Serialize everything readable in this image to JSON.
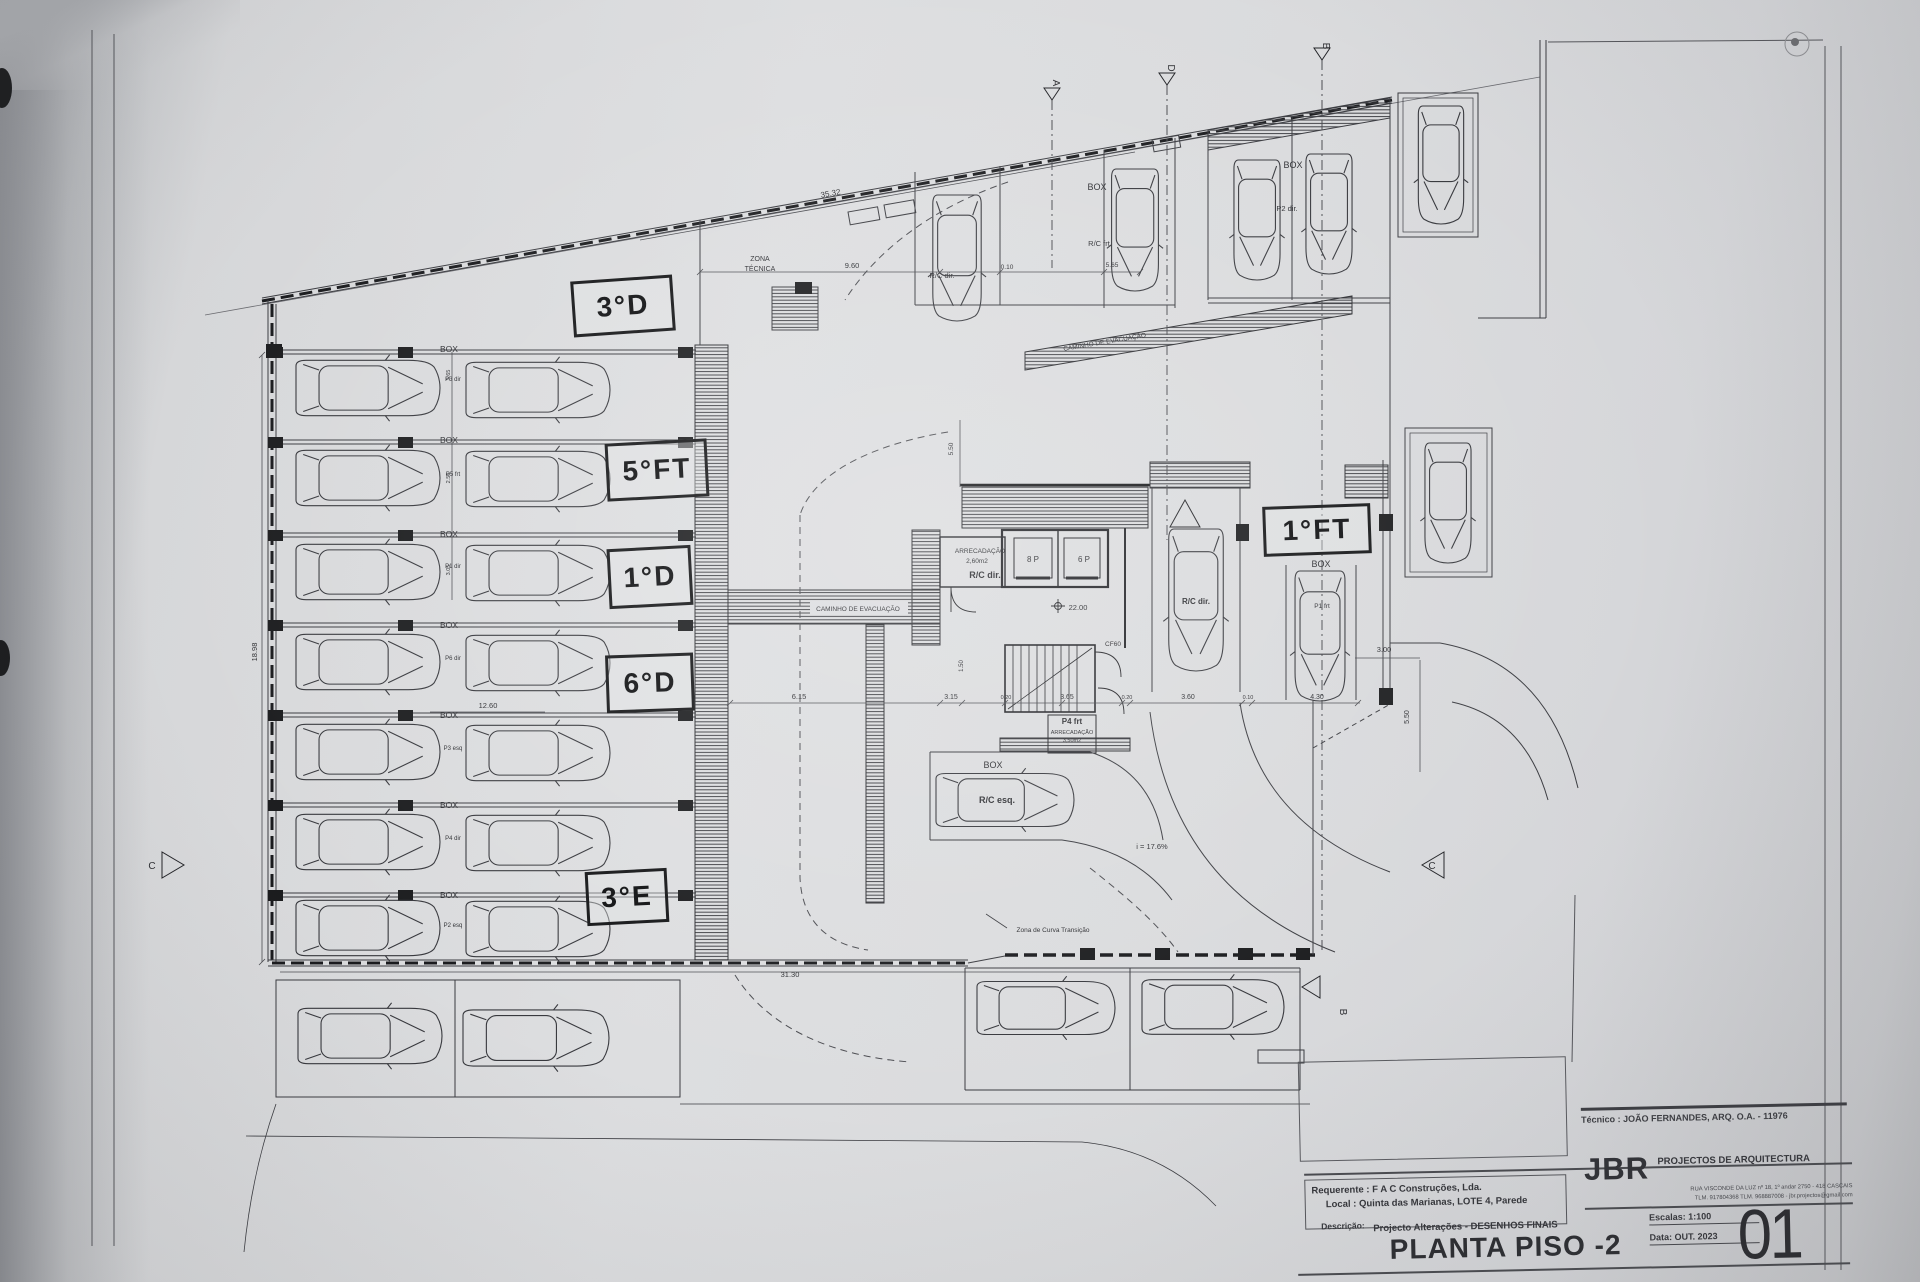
{
  "titleblock": {
    "tecnico": "Técnico : JOÃO FERNANDES, ARQ.   O.A. - 11976",
    "firm_name": "JBR",
    "firm_tagline": "PROJECTOS DE ARQUITECTURA",
    "firm_addr1": "RUA VISCONDE DA LUZ nº 18, 1º andar  2750 - 418  CASCAIS",
    "firm_addr2": "TLM. 917804368 TLM. 968887008 - jbr.projectos@gmail.com",
    "requerente": "Requerente : F A C  Construções, Lda.",
    "local": "Local : Quinta das Marianas, LOTE 4, Parede",
    "descricao_label": "Descrição:",
    "descricao_value": "Projecto Alterações - DESENHOS FINAIS",
    "drawing_title": "PLANTA PISO -2",
    "escala": "Escalas:  1:100",
    "data": "Data: OUT.  2023",
    "sheet_number": "01"
  },
  "handwritten": [
    {
      "text": "3°D",
      "x": 572,
      "y": 278,
      "w": 96,
      "h": 50,
      "rot": -4
    },
    {
      "text": "5°FT",
      "x": 606,
      "y": 441,
      "w": 96,
      "h": 52,
      "rot": -3
    },
    {
      "text": "1°D",
      "x": 608,
      "y": 547,
      "w": 78,
      "h": 54,
      "rot": -3
    },
    {
      "text": "6°D",
      "x": 606,
      "y": 654,
      "w": 82,
      "h": 52,
      "rot": -2
    },
    {
      "text": "3°E",
      "x": 586,
      "y": 870,
      "w": 76,
      "h": 48,
      "rot": -3
    },
    {
      "text": "1°FT",
      "x": 1263,
      "y": 505,
      "w": 102,
      "h": 44,
      "rot": -2
    }
  ],
  "plan": {
    "labels": [
      {
        "t": "ZONA",
        "x": 760,
        "y": 261,
        "s": 7
      },
      {
        "t": "TÉCNICA",
        "x": 760,
        "y": 271,
        "s": 7
      },
      {
        "t": "35.32",
        "x": 831,
        "y": 196,
        "s": 8,
        "r": -10
      },
      {
        "t": "9.60",
        "x": 852,
        "y": 268,
        "s": 7.5
      },
      {
        "t": "0.10",
        "x": 1007,
        "y": 269,
        "s": 6.5
      },
      {
        "t": "5.65",
        "x": 1112,
        "y": 267,
        "s": 6.5
      },
      {
        "t": "R/C dir.",
        "x": 942,
        "y": 278,
        "s": 7.5
      },
      {
        "t": "BOX",
        "x": 1097,
        "y": 190,
        "s": 9
      },
      {
        "t": "R/C frt",
        "x": 1099,
        "y": 246,
        "s": 7.5
      },
      {
        "t": "BOX",
        "x": 1293,
        "y": 168,
        "s": 9
      },
      {
        "t": "P2 dir.",
        "x": 1287,
        "y": 211,
        "s": 7.5
      },
      {
        "t": "CAMINHO DE EVACUAÇÃO",
        "x": 1105,
        "y": 344,
        "s": 6.5,
        "r": -9.5
      },
      {
        "t": "CAMINHO DE EVACUAÇÃO",
        "x": 858,
        "y": 611,
        "s": 6.5
      },
      {
        "t": "ARRECADAÇÃO",
        "x": 980,
        "y": 553,
        "s": 6.5
      },
      {
        "t": "2,60m2",
        "x": 977,
        "y": 563,
        "s": 6.5
      },
      {
        "t": "R/C dir.",
        "x": 985,
        "y": 578,
        "s": 9,
        "b": 1
      },
      {
        "t": "8 P",
        "x": 1033,
        "y": 562,
        "s": 8
      },
      {
        "t": "6 P",
        "x": 1084,
        "y": 562,
        "s": 8
      },
      {
        "t": "22.00",
        "x": 1078,
        "y": 610,
        "s": 7.5
      },
      {
        "t": "CF60",
        "x": 1113,
        "y": 646,
        "s": 6.5
      },
      {
        "t": "P4 frt",
        "x": 1072,
        "y": 724,
        "s": 8,
        "b": 1
      },
      {
        "t": "ARRECADAÇÃO",
        "x": 1072,
        "y": 734,
        "s": 5.5
      },
      {
        "t": "3,50m2",
        "x": 1072,
        "y": 742,
        "s": 5.5
      },
      {
        "t": "1.50",
        "x": 963,
        "y": 666,
        "s": 6,
        "r": -90
      },
      {
        "t": "5.50",
        "x": 953,
        "y": 449,
        "s": 6.5,
        "r": -90
      },
      {
        "t": "BOX",
        "x": 1321,
        "y": 567,
        "s": 9
      },
      {
        "t": "P1 frt",
        "x": 1322,
        "y": 608,
        "s": 6.5
      },
      {
        "t": "R/C dir.",
        "x": 1196,
        "y": 604,
        "s": 8,
        "b": 1
      },
      {
        "t": "3.00",
        "x": 1384,
        "y": 652,
        "s": 7.5
      },
      {
        "t": "5.50",
        "x": 1409,
        "y": 717,
        "s": 7,
        "r": -90
      },
      {
        "t": "BOX",
        "x": 993,
        "y": 768,
        "s": 9
      },
      {
        "t": "R/C esq.",
        "x": 997,
        "y": 803,
        "s": 9,
        "b": 1
      },
      {
        "t": "i = 17.6%",
        "x": 1152,
        "y": 849,
        "s": 7.5
      },
      {
        "t": "Zona de Curva Transição",
        "x": 1053,
        "y": 932,
        "s": 6.5
      },
      {
        "t": "31.30",
        "x": 790,
        "y": 977,
        "s": 7.5
      },
      {
        "t": "6.15",
        "x": 799,
        "y": 699,
        "s": 7.5
      },
      {
        "t": "3.15",
        "x": 951,
        "y": 699,
        "s": 7
      },
      {
        "t": "0.20",
        "x": 1006,
        "y": 699,
        "s": 5.5
      },
      {
        "t": "3.65",
        "x": 1067,
        "y": 699,
        "s": 7
      },
      {
        "t": "0.20",
        "x": 1127,
        "y": 699,
        "s": 5.5
      },
      {
        "t": "3.60",
        "x": 1188,
        "y": 699,
        "s": 7
      },
      {
        "t": "0.10",
        "x": 1248,
        "y": 699,
        "s": 5.5
      },
      {
        "t": "4.30",
        "x": 1317,
        "y": 699,
        "s": 7
      },
      {
        "t": "12.60",
        "x": 488,
        "y": 708,
        "s": 7.5
      },
      {
        "t": "18.98",
        "x": 257,
        "y": 652,
        "s": 7.5,
        "r": -90
      },
      {
        "t": "BOX",
        "x": 449,
        "y": 352,
        "s": 8.5
      },
      {
        "t": "BOX",
        "x": 449,
        "y": 443,
        "s": 8.5
      },
      {
        "t": "BOX",
        "x": 449,
        "y": 537,
        "s": 8.5
      },
      {
        "t": "BOX",
        "x": 449,
        "y": 628,
        "s": 8.5
      },
      {
        "t": "BOX",
        "x": 449,
        "y": 718,
        "s": 8.5
      },
      {
        "t": "BOX",
        "x": 449,
        "y": 808,
        "s": 8.5
      },
      {
        "t": "BOX",
        "x": 449,
        "y": 898,
        "s": 8.5
      },
      {
        "t": "P3 dir",
        "x": 453,
        "y": 381,
        "s": 6
      },
      {
        "t": "P5 frt",
        "x": 453,
        "y": 476,
        "s": 6
      },
      {
        "t": "P1 dir",
        "x": 453,
        "y": 568,
        "s": 6
      },
      {
        "t": "P6 dir",
        "x": 453,
        "y": 660,
        "s": 6
      },
      {
        "t": "P3 esq",
        "x": 453,
        "y": 750,
        "s": 6
      },
      {
        "t": "P4 dir",
        "x": 453,
        "y": 840,
        "s": 6
      },
      {
        "t": "P2 esq",
        "x": 453,
        "y": 927,
        "s": 6
      },
      {
        "t": "3.65",
        "x": 450,
        "y": 375,
        "s": 5.5,
        "r": -90
      },
      {
        "t": "2.50",
        "x": 450,
        "y": 478,
        "s": 5.5,
        "r": -90
      },
      {
        "t": "3.05",
        "x": 450,
        "y": 570,
        "s": 5.5,
        "r": -90
      },
      {
        "t": "A",
        "x": 1053,
        "y": 83,
        "s": 10,
        "r": 90
      },
      {
        "t": "D",
        "x": 1168,
        "y": 68,
        "s": 10,
        "r": 90
      },
      {
        "t": "B",
        "x": 1323,
        "y": 46,
        "s": 10,
        "r": 90
      },
      {
        "t": "B",
        "x": 1340,
        "y": 1012,
        "s": 10,
        "r": 90
      },
      {
        "t": "C",
        "x": 152,
        "y": 869,
        "s": 10
      },
      {
        "t": "C",
        "x": 1432,
        "y": 869,
        "s": 10
      }
    ],
    "cars": [
      {
        "x": 368,
        "y": 388,
        "r": 0,
        "l": 144
      },
      {
        "x": 538,
        "y": 390,
        "r": 0,
        "l": 144
      },
      {
        "x": 368,
        "y": 478,
        "r": 0,
        "l": 144
      },
      {
        "x": 538,
        "y": 479,
        "r": 0,
        "l": 144
      },
      {
        "x": 368,
        "y": 572,
        "r": 0,
        "l": 144
      },
      {
        "x": 538,
        "y": 573,
        "r": 0,
        "l": 144
      },
      {
        "x": 368,
        "y": 662,
        "r": 0,
        "l": 144
      },
      {
        "x": 538,
        "y": 663,
        "r": 0,
        "l": 144
      },
      {
        "x": 368,
        "y": 752,
        "r": 0,
        "l": 144
      },
      {
        "x": 538,
        "y": 753,
        "r": 0,
        "l": 144
      },
      {
        "x": 368,
        "y": 842,
        "r": 0,
        "l": 144
      },
      {
        "x": 538,
        "y": 843,
        "r": 0,
        "l": 144
      },
      {
        "x": 368,
        "y": 928,
        "r": 0,
        "l": 144
      },
      {
        "x": 538,
        "y": 929,
        "r": 0,
        "l": 144
      },
      {
        "x": 957,
        "y": 258,
        "r": 90,
        "l": 126
      },
      {
        "x": 1135,
        "y": 230,
        "r": 90,
        "l": 122
      },
      {
        "x": 1257,
        "y": 220,
        "r": 90,
        "l": 120
      },
      {
        "x": 1329,
        "y": 214,
        "r": 90,
        "l": 120
      },
      {
        "x": 1441,
        "y": 165,
        "r": 90,
        "l": 118
      },
      {
        "x": 1448,
        "y": 503,
        "r": 90,
        "l": 120
      },
      {
        "x": 1196,
        "y": 600,
        "r": 90,
        "l": 142
      },
      {
        "x": 1320,
        "y": 636,
        "r": 90,
        "l": 130
      },
      {
        "x": 1005,
        "y": 800,
        "r": 0,
        "l": 138
      },
      {
        "x": 370,
        "y": 1036,
        "r": 0,
        "l": 144
      },
      {
        "x": 536,
        "y": 1038,
        "r": 0,
        "l": 146
      },
      {
        "x": 1046,
        "y": 1008,
        "r": 0,
        "l": 138
      },
      {
        "x": 1213,
        "y": 1007,
        "r": 0,
        "l": 142
      }
    ]
  }
}
